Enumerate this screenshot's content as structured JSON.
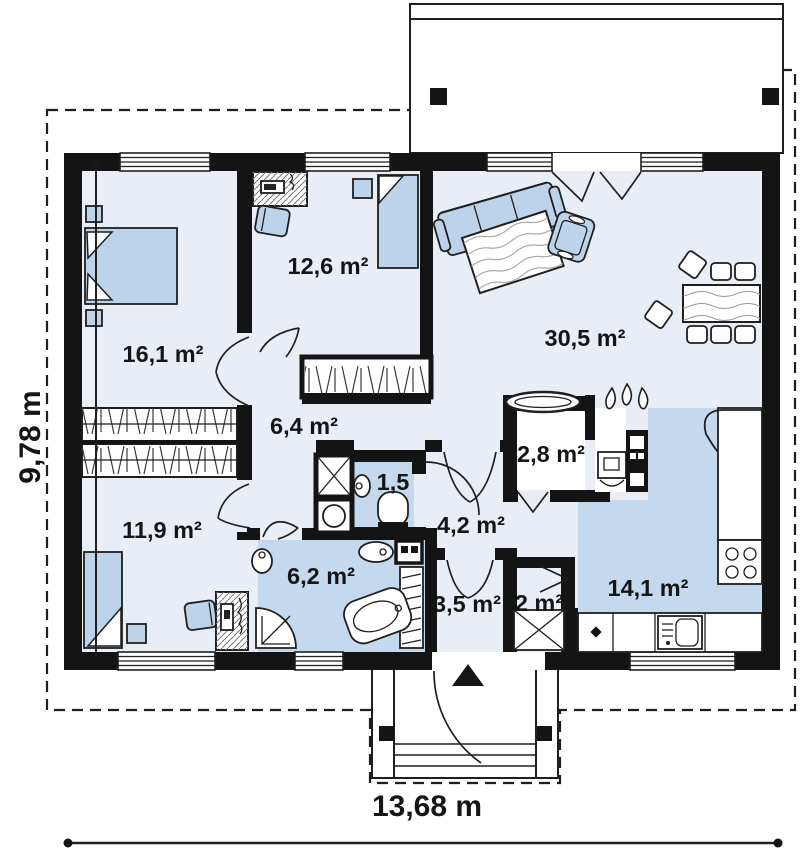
{
  "plan_type": "single-storey house floor plan",
  "dimensions": {
    "width_label": "13,68 m",
    "height_label": "9,78 m"
  },
  "rooms": [
    {
      "id": "bedroom-1",
      "area_label": "16,1 m²"
    },
    {
      "id": "bedroom-2",
      "area_label": "12,6 m²"
    },
    {
      "id": "living-room",
      "area_label": "30,5 m²"
    },
    {
      "id": "hallway",
      "area_label": "6,4 m²"
    },
    {
      "id": "wc",
      "area_label": "1,5"
    },
    {
      "id": "corridor",
      "area_label": "4,2 m²"
    },
    {
      "id": "pantry",
      "area_label": "2,8 m²"
    },
    {
      "id": "bedroom-3",
      "area_label": "11,9 m²"
    },
    {
      "id": "bathroom",
      "area_label": "6,2 m²"
    },
    {
      "id": "entry",
      "area_label": "3,5 m²"
    },
    {
      "id": "closet",
      "area_label": "2 m²"
    },
    {
      "id": "kitchen",
      "area_label": "14,1 m²"
    }
  ],
  "colors": {
    "wall": "#141414",
    "floor": "#e9eef6",
    "wet": "#c5d9ee",
    "furn": "#bdd3ea",
    "line": "#1f1f1f"
  }
}
